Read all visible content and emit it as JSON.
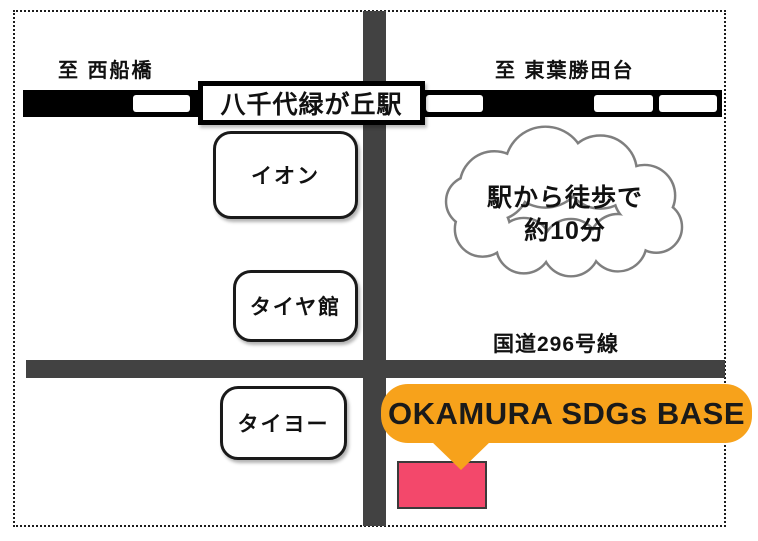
{
  "map": {
    "kind": "station-access-map",
    "station": "八千代緑が丘駅",
    "direction_left": "至 西船橋",
    "direction_right": "至 東葉勝田台",
    "buildings": [
      {
        "label": "イオン"
      },
      {
        "label": "タイヤ館"
      },
      {
        "label": "タイヨー"
      }
    ],
    "cloud": {
      "line1": "駅から徒歩で",
      "line2": "約10分"
    },
    "road_label": "国道296号線",
    "destination": {
      "label": "OKAMURA SDGs BASE"
    },
    "colors": {
      "road": "#424242",
      "railway": "#000000",
      "cloud_outline": "#7f7f7f",
      "callout_orange": "#F7A21B",
      "destination_pink": "#F3486B"
    }
  }
}
